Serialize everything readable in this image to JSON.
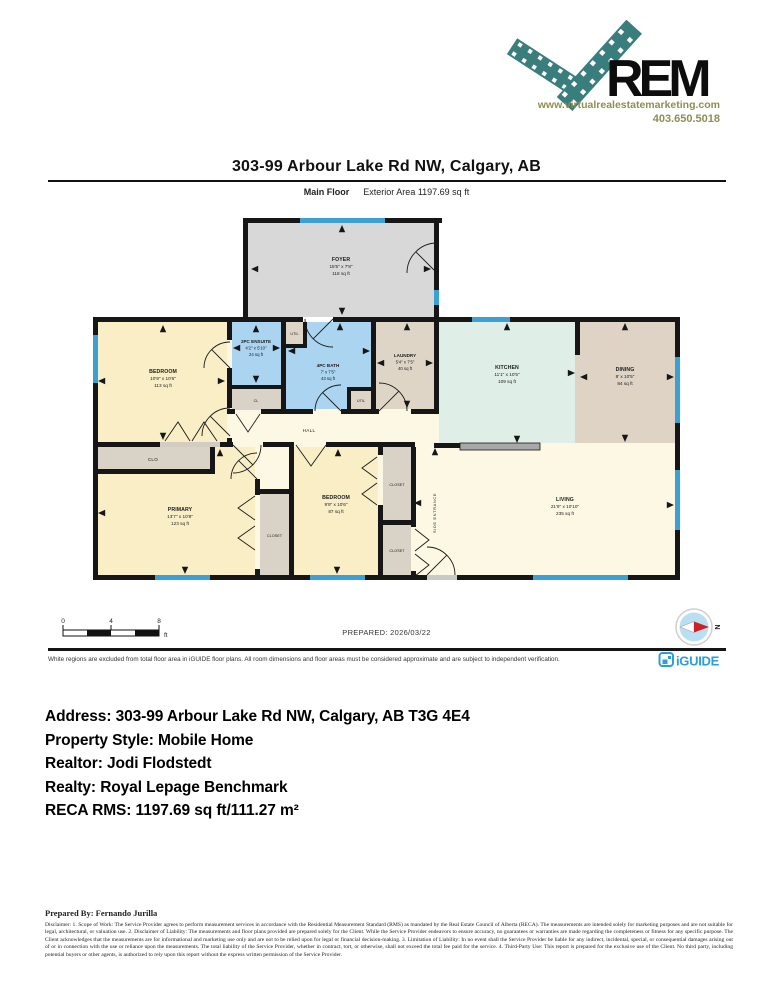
{
  "logo": {
    "brand": "REM",
    "url": "www.virtualrealestatemarketing.com",
    "phone": "403.650.5018",
    "teal": "#3a7d7d",
    "olive": "#8e8e52"
  },
  "header": {
    "title": "303-99 Arbour Lake Rd NW, Calgary, AB",
    "floor_label": "Main Floor",
    "exterior_area": "Exterior Area 1197.69 sq ft"
  },
  "floorplan": {
    "rooms": [
      {
        "name": "FOYER",
        "dims": "15'5\" x 7'8\"",
        "area": "118 sq ft"
      },
      {
        "name": "BEDROOM",
        "dims": "10'9\" x 10'6\"",
        "area": "113 sq ft"
      },
      {
        "name": "2PC ENSUITE",
        "dims": "4'2\" x 5'10\"",
        "area": "24 sq ft"
      },
      {
        "name": "4PC BATH",
        "dims": "7' x 7'5\"",
        "area": "43 sq ft"
      },
      {
        "name": "LAUNDRY",
        "dims": "5'4\" x 7'5\"",
        "area": "40 sq ft"
      },
      {
        "name": "KITCHEN",
        "dims": "11'1\" x 10'5\"",
        "area": "109 sq ft"
      },
      {
        "name": "DINING",
        "dims": "8' x 10'5\"",
        "area": "84 sq ft"
      },
      {
        "name": "PRIMARY",
        "dims": "13'7\" x 10'8\"",
        "area": "123 sq ft"
      },
      {
        "name": "BEDROOM",
        "dims": "9'9\" x 10'6\"",
        "area": "87 sq ft"
      },
      {
        "name": "LIVING",
        "dims": "21'9\" x 10'10\"",
        "area": "235 sq ft"
      }
    ],
    "labels": {
      "hall": "HALL",
      "util": "UTIL",
      "cl": "CL",
      "clo": "CLO",
      "closet": "CLOSET",
      "side_entrance": "SIDE ENTRANCE"
    },
    "colors": {
      "window": "#3da0d5",
      "wall": "#161616",
      "foyer": "#d8d8d8",
      "bedroom_cream": "#faeec6",
      "open_cream": "#fdf8e3",
      "wet_blue": "#aad4f0",
      "tan": "#ded5c7",
      "closet_gray": "#d9d2c6",
      "kitchen_mint": "#dfeee7",
      "dining_tan": "#ded3c5"
    }
  },
  "footer": {
    "scale": {
      "labels": [
        "0",
        "4",
        "8"
      ],
      "unit": "ft"
    },
    "prepared": "PREPARED: 2026/03/22",
    "compass_n": "N",
    "iguide": "iGUIDE",
    "note": "White regions are excluded from total floor area in iGUIDE floor plans. All room dimensions and floor areas must be considered approximate and are subject to independent verification."
  },
  "info": {
    "address": "Address: 303-99 Arbour Lake Rd NW, Calgary, AB T3G 4E4",
    "property_style": "Property Style: Mobile Home",
    "realtor": "Realtor: Jodi Flodstedt",
    "realty": "Realty: Royal Lepage Benchmark",
    "reca_rms": "RECA RMS: 1197.69 sq ft/111.27 m²"
  },
  "prepared_by": "Prepared By: Fernando Jurilla",
  "disclaimer": "Disclaimer: 1. Scope of Work: The Service Provider agrees to perform measurement services in accordance with the Residential Measurement Standard (RMS) as mandated by the Real Estate Council of Alberta (RECA). The measurements are intended solely for marketing purposes and are not suitable for legal, architectural, or valuation use. 2. Disclaimer of Liability: The measurements and floor plans provided are prepared solely for the Client. While the Service Provider endeavors to ensure accuracy, no guarantees or warranties are made regarding the completeness or fitness for any specific purpose. The Client acknowledges that the measurements are for informational and marketing use only and are not to be relied upon for legal or financial decision-making. 3. Limitation of Liability: In no event shall the Service Provider be liable for any indirect, incidental, special, or consequential damages arising out of or in connection with the use or reliance upon the measurements. The total liability of the Service Provider, whether in contract, tort, or otherwise, shall not exceed the total fee paid for the service. 4. Third-Party Use: This report is prepared for the exclusive use of the Client. No third party, including potential buyers or other agents, is authorized to rely upon this report without the express written permission of the Service Provider."
}
